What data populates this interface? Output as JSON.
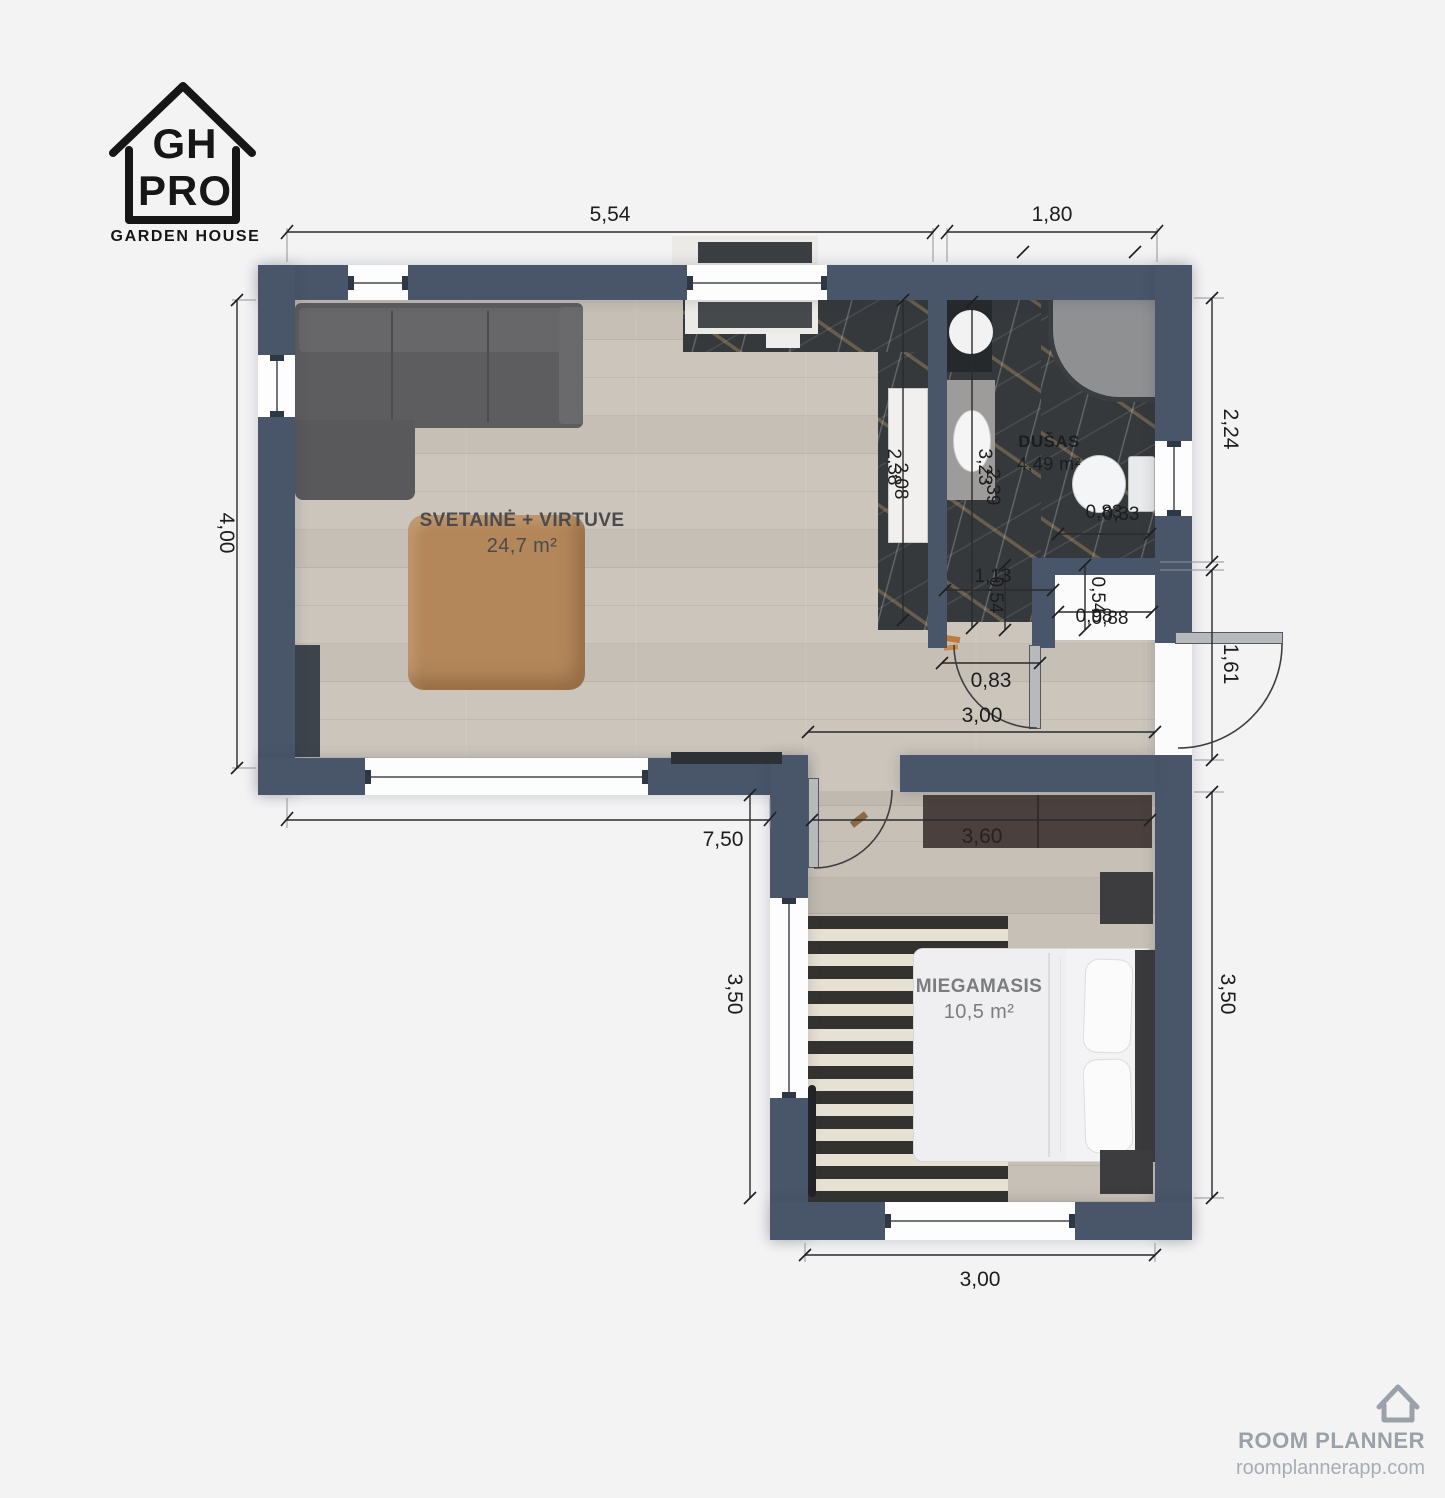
{
  "logo": {
    "line1": "GH",
    "line2": "PRO",
    "subtitle": "GARDEN HOUSE"
  },
  "watermark": {
    "name": "ROOM PLANNER",
    "url": "roomplannerapp.com"
  },
  "rooms": {
    "living": {
      "name": "SVETAINĖ + VIRTUVE",
      "area": "24,7 m²"
    },
    "bathroom": {
      "name": "DUŠAS",
      "area": "4,49 m²"
    },
    "bedroom": {
      "name": "MIEGAMASIS",
      "area": "10,5 m²"
    }
  },
  "dimensions": {
    "top_living": "5,54",
    "top_bathroom": "1,80",
    "left_living": "4,00",
    "right_bathroom": "2,24",
    "right_entry": "1,61",
    "right_bedroom": "3,50",
    "bottom_living": "7,50",
    "bedroom_left": "3,50",
    "bedroom_bottom": "3,00",
    "hallway_width": "3,00",
    "bathroom_door": "0,83",
    "wardrobe_width": "3,60",
    "bathroom_inner_width": "1,13",
    "bathroom_depth_a": "2,38",
    "bathroom_depth_b": "2,08",
    "bathroom_inner_height_a": "3,23",
    "bathroom_inner_height_b": "2,39",
    "niche_height_left": "0,54",
    "niche_height_right": "0,54",
    "niche_width_a": "0,98",
    "niche_width_b": "0,88",
    "toilet_width_a": "0,83",
    "toilet_width_b": "0,33"
  },
  "colors": {
    "background": "#f3f3f4",
    "wall": "#49566a",
    "floor": "#cbc5bc",
    "floor_bedroom": "#c7c0b7",
    "marble": "#35393c",
    "table_wood": "#b3875a",
    "wardrobe": "#4a403d",
    "sofa": "#5d5d5f",
    "dim_text": "#1d1d1f",
    "watermark": "#9aa1a8"
  }
}
